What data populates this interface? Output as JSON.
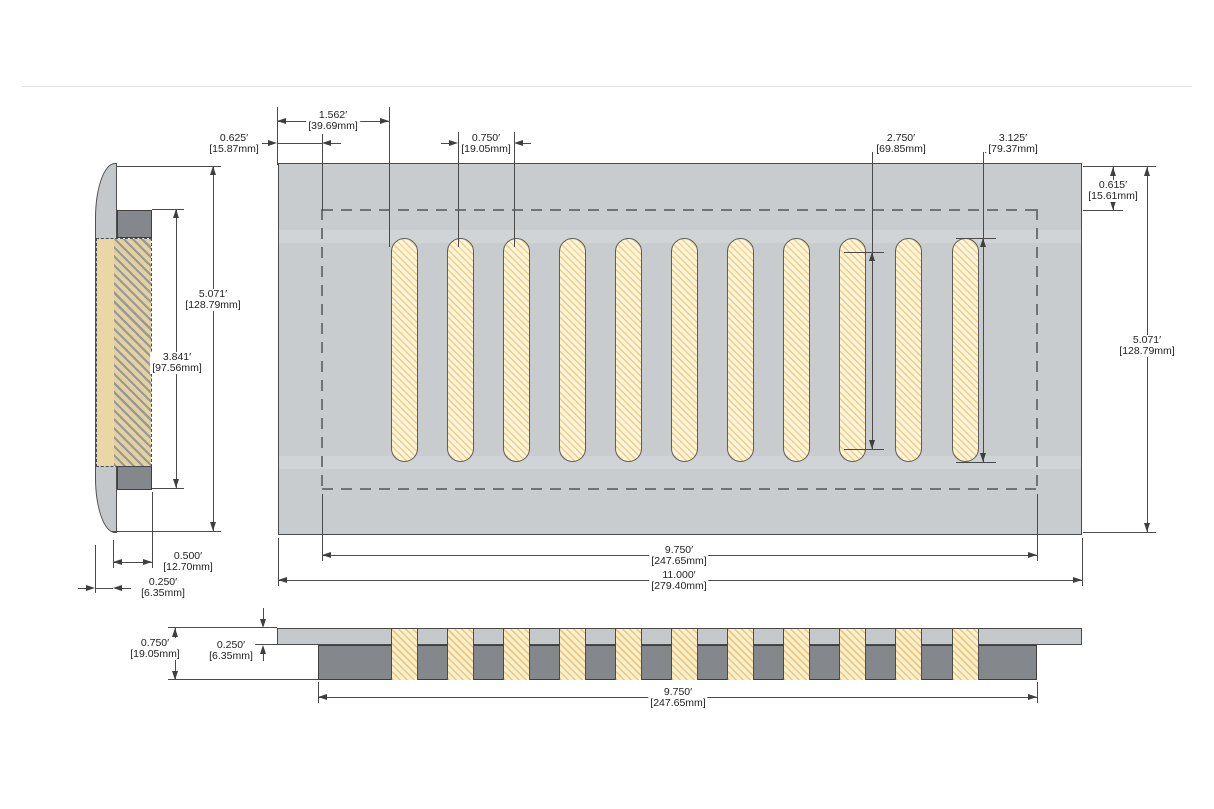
{
  "drawing": {
    "description": "floor vent register dimension drawing, front view, side view and bottom section view",
    "slot_count": 11,
    "colors": {
      "plate_gray": "#c9cccf",
      "duct_gray": "#84878b",
      "slot_cream": "#fcf5dc",
      "slot_hatch_orange": "#f0c672",
      "side_hatch_beige": "#e3d2a0",
      "dimension_line": "#4a4a4a"
    },
    "dims": {
      "slot_offset": {
        "in": "1.562′",
        "mm": "[39.69mm]"
      },
      "duct_inset_left": {
        "in": "0.625′",
        "mm": "[15.87mm]"
      },
      "slot_pitch": {
        "in": "0.750′",
        "mm": "[19.05mm]"
      },
      "slot_straight": {
        "in": "2.750′",
        "mm": "[69.85mm]"
      },
      "slot_overall": {
        "in": "3.125′",
        "mm": "[79.37mm]"
      },
      "duct_inset_top": {
        "in": "0.615′",
        "mm": "[15.61mm]"
      },
      "overall_height": {
        "in": "5.071′",
        "mm": "[128.79mm]"
      },
      "duct_width_main": {
        "in": "9.750′",
        "mm": "[247.65mm]"
      },
      "overall_width": {
        "in": "11.000′",
        "mm": "[279.40mm]"
      },
      "side_height": {
        "in": "5.071′",
        "mm": "[128.79mm]"
      },
      "duct_opening_height": {
        "in": "3.841′",
        "mm": "[97.56mm]"
      },
      "duct_depth": {
        "in": "0.500′",
        "mm": "[12.70mm]"
      },
      "flange_thickness": {
        "in": "0.250′",
        "mm": "[6.35mm]"
      },
      "section_depth": {
        "in": "0.750′",
        "mm": "[19.05mm]"
      },
      "section_plate": {
        "in": "0.250′",
        "mm": "[6.35mm]"
      },
      "section_duct_width": {
        "in": "9.750′",
        "mm": "[247.65mm]"
      }
    }
  }
}
